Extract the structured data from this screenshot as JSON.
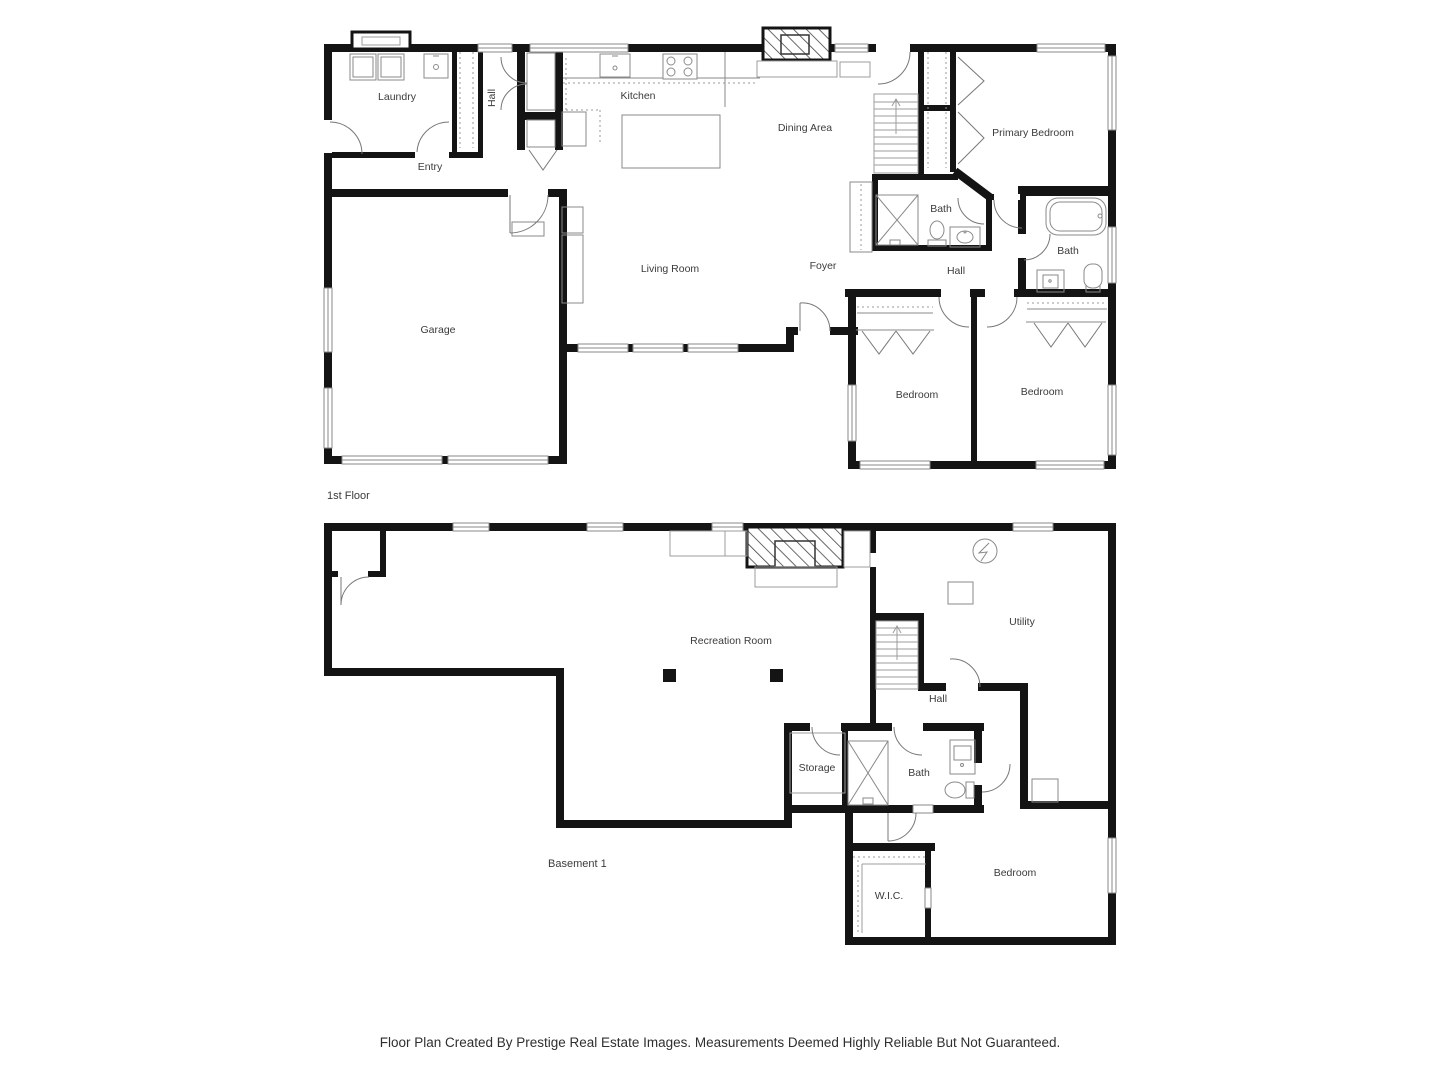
{
  "document": {
    "type": "real-estate-floor-plan",
    "background": "#ffffff"
  },
  "colors": {
    "wall": "#141414",
    "label_text": "#3b3b3b",
    "fixture_line": "#8a8a8a",
    "hatch_line": "#444444"
  },
  "floor1": {
    "title": "1st Floor",
    "labels": {
      "laundry": "Laundry",
      "hall_upper": "Hall",
      "kitchen": "Kitchen",
      "dining": "Dining Area",
      "primary_bedroom": "Primary Bedroom",
      "entry": "Entry",
      "bath1": "Bath",
      "bath2": "Bath",
      "living": "Living Room",
      "foyer": "Foyer",
      "hall_lower": "Hall",
      "garage": "Garage",
      "bedroom1": "Bedroom",
      "bedroom2": "Bedroom"
    }
  },
  "floor2": {
    "title": "Basement 1",
    "labels": {
      "recreation": "Recreation Room",
      "utility": "Utility",
      "hall": "Hall",
      "storage": "Storage",
      "bath": "Bath",
      "bedroom": "Bedroom",
      "wic": "W.I.C."
    }
  },
  "footer": {
    "text": "Floor Plan Created By Prestige Real Estate Images. Measurements Deemed Highly Reliable But Not Guaranteed."
  }
}
